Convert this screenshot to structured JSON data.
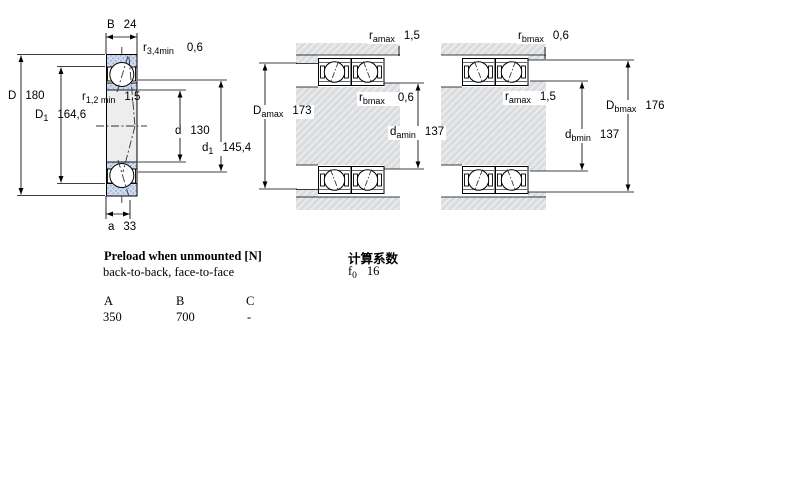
{
  "left_diagram": {
    "width_B": {
      "sym": "B",
      "value": "24"
    },
    "corner_radius_outer": {
      "sym": "r",
      "sub": "3,4min",
      "value": "0,6"
    },
    "outer_diameter_D": {
      "sym": "D",
      "value": "180"
    },
    "shoulder_D1": {
      "sym": "D",
      "sub": "1",
      "value": "164,6"
    },
    "corner_radius_inner": {
      "sym": "r",
      "sub": "1,2 min",
      "value": "1,5"
    },
    "bore_diameter_d": {
      "sym": "d",
      "value": "130"
    },
    "shoulder_d1": {
      "sym": "d",
      "sub": "1",
      "value": "145,4"
    },
    "contact_offset_a": {
      "sym": "a",
      "value": "33"
    }
  },
  "mounting_left": {
    "r_amax": {
      "sym": "r",
      "sub": "amax",
      "value": "1,5"
    },
    "r_bmax": {
      "sym": "r",
      "sub": "bmax",
      "value": "0,6"
    },
    "D_amax": {
      "sym": "D",
      "sub": "amax",
      "value": "173"
    },
    "d_amin": {
      "sym": "d",
      "sub": "amin",
      "value": "137"
    }
  },
  "mounting_right": {
    "r_bmax": {
      "sym": "r",
      "sub": "bmax",
      "value": "0,6"
    },
    "r_amax": {
      "sym": "r",
      "sub": "amax",
      "value": "1,5"
    },
    "d_bmin": {
      "sym": "d",
      "sub": "bmin",
      "value": "137"
    },
    "D_bmax": {
      "sym": "D",
      "sub": "bmax",
      "value": "176"
    }
  },
  "preload": {
    "title": "Preload when unmounted [N]",
    "subtitle": "back-to-back, face-to-face",
    "columns": [
      "A",
      "B",
      "C"
    ],
    "values": [
      "350",
      "700",
      "-"
    ]
  },
  "calculation": {
    "title": "计算系数",
    "factor": {
      "sym": "f",
      "sub": "0",
      "value": "16"
    }
  },
  "colors": {
    "ring_hatch": "#cfdaee",
    "ring_hatch_dot": "#9aaed3",
    "steel_gray": "#e0e2e4",
    "line": "#000000"
  }
}
